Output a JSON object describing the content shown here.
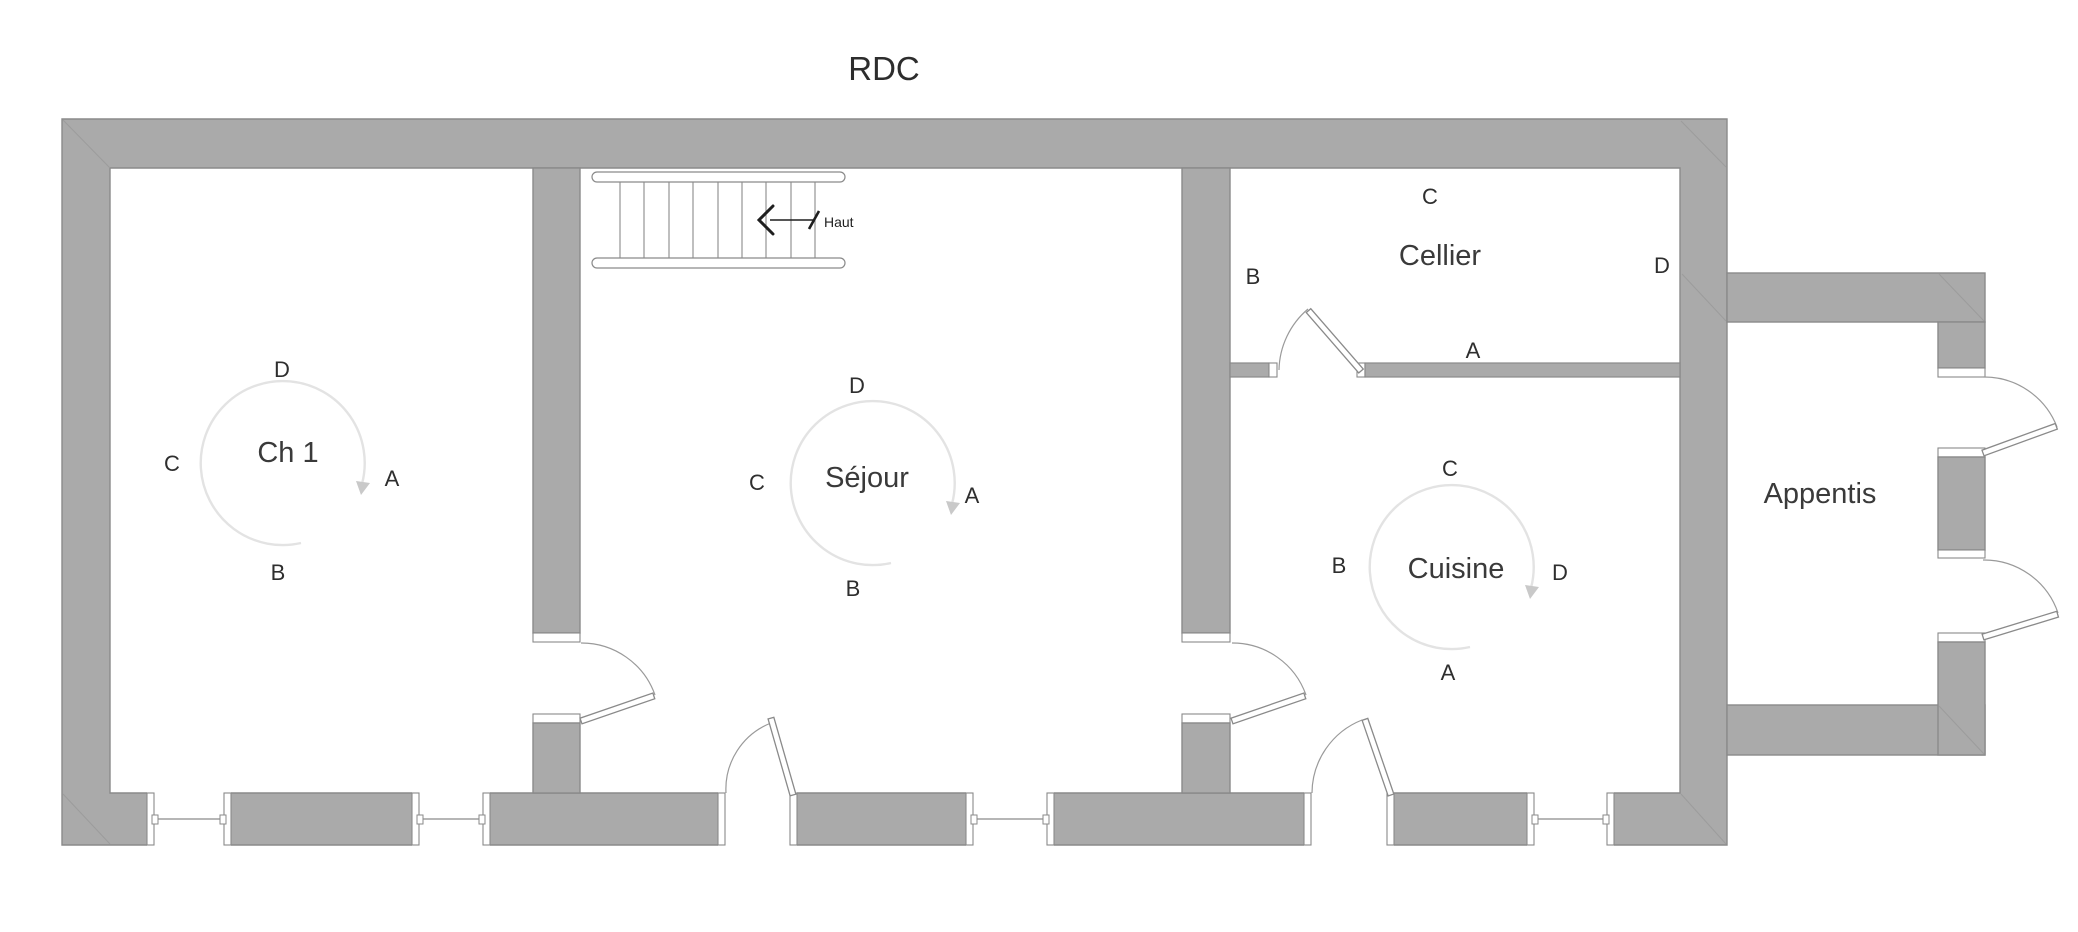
{
  "title": "RDC",
  "stairs": {
    "direction_label": "Haut"
  },
  "rooms": {
    "ch1": {
      "name": "Ch 1",
      "letters": {
        "top": "D",
        "left": "C",
        "right": "A",
        "bottom": "B"
      }
    },
    "sejour": {
      "name": "Séjour",
      "letters": {
        "top": "D",
        "left": "C",
        "right": "A",
        "bottom": "B"
      }
    },
    "cellier": {
      "name": "Cellier",
      "letters": {
        "top": "C",
        "left": "B",
        "right": "D",
        "bottom": "A"
      }
    },
    "cuisine": {
      "name": "Cuisine",
      "letters": {
        "top": "C",
        "left": "B",
        "right": "D",
        "bottom": "A"
      }
    },
    "appentis": {
      "name": "Appentis"
    }
  },
  "colors": {
    "wall_fill": "#aaaaaa",
    "wall_outline": "#8a8a8a",
    "compass_circle": "#e3e3e3",
    "compass_arrow": "#c9c9c9",
    "label_text": "#3a3a3a"
  }
}
